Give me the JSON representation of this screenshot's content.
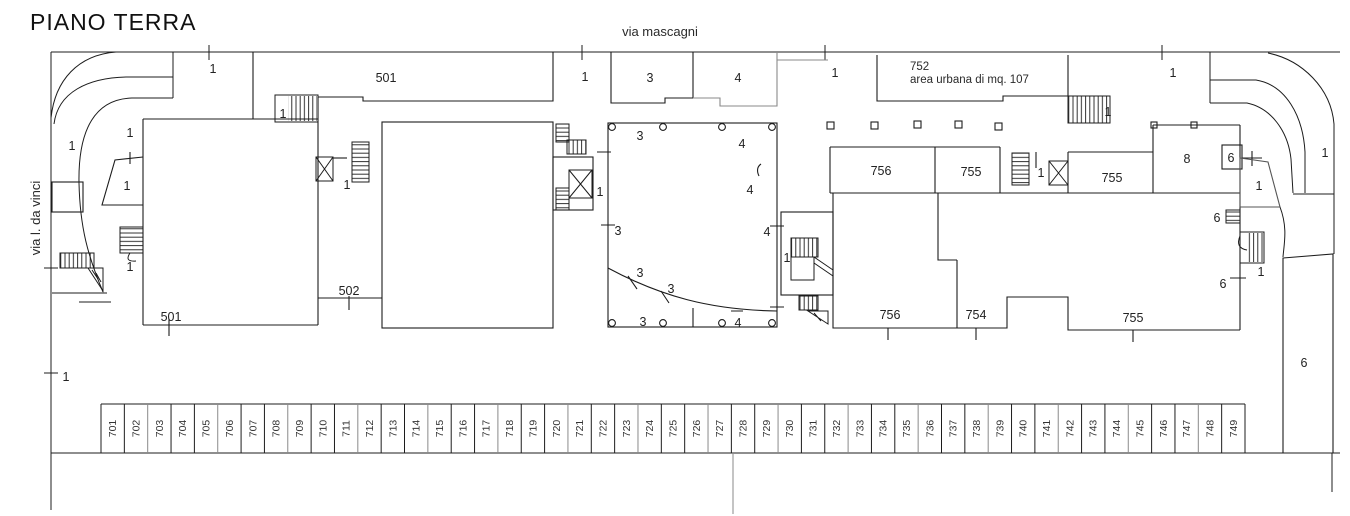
{
  "title": "PIANO TERRA",
  "streets": {
    "top": "via mascagni",
    "left": "via l. da vinci"
  },
  "parcel_752": {
    "number": "752",
    "note": "area urbana di mq. 107"
  },
  "colors": {
    "line": "#1c1c1c",
    "line_gray": "#8a8a8a",
    "text": "#222222",
    "background": "#ffffff"
  },
  "plan_labels": [
    {
      "t": "1",
      "x": 213,
      "y": 73
    },
    {
      "t": "1",
      "x": 585,
      "y": 81
    },
    {
      "t": "1",
      "x": 835,
      "y": 77
    },
    {
      "t": "1",
      "x": 1173,
      "y": 77
    },
    {
      "t": "501",
      "x": 386,
      "y": 82
    },
    {
      "t": "3",
      "x": 650,
      "y": 82
    },
    {
      "t": "4",
      "x": 738,
      "y": 82
    },
    {
      "t": "1",
      "x": 283,
      "y": 118
    },
    {
      "t": "1",
      "x": 72,
      "y": 150
    },
    {
      "t": "1",
      "x": 130,
      "y": 137
    },
    {
      "t": "1",
      "x": 127,
      "y": 190
    },
    {
      "t": "1",
      "x": 130,
      "y": 271
    },
    {
      "t": "1",
      "x": 347,
      "y": 189
    },
    {
      "t": "502",
      "x": 349,
      "y": 295
    },
    {
      "t": "501",
      "x": 171,
      "y": 321
    },
    {
      "t": "1",
      "x": 600,
      "y": 196
    },
    {
      "t": "3",
      "x": 640,
      "y": 140
    },
    {
      "t": "4",
      "x": 742,
      "y": 148
    },
    {
      "t": "4",
      "x": 750,
      "y": 194
    },
    {
      "t": "3",
      "x": 618,
      "y": 235
    },
    {
      "t": "4",
      "x": 767,
      "y": 236
    },
    {
      "t": "3",
      "x": 640,
      "y": 277
    },
    {
      "t": "3",
      "x": 671,
      "y": 293
    },
    {
      "t": "3",
      "x": 643,
      "y": 326
    },
    {
      "t": "4",
      "x": 738,
      "y": 327
    },
    {
      "t": "1",
      "x": 787,
      "y": 262
    },
    {
      "t": "1",
      "x": 1108,
      "y": 116
    },
    {
      "t": "756",
      "x": 881,
      "y": 175
    },
    {
      "t": "755",
      "x": 971,
      "y": 176
    },
    {
      "t": "1",
      "x": 1041,
      "y": 177
    },
    {
      "t": "755",
      "x": 1112,
      "y": 182
    },
    {
      "t": "8",
      "x": 1187,
      "y": 163
    },
    {
      "t": "6",
      "x": 1231,
      "y": 162
    },
    {
      "t": "1",
      "x": 1259,
      "y": 190
    },
    {
      "t": "1",
      "x": 1325,
      "y": 157
    },
    {
      "t": "6",
      "x": 1217,
      "y": 222
    },
    {
      "t": "1",
      "x": 1261,
      "y": 276
    },
    {
      "t": "6",
      "x": 1223,
      "y": 288
    },
    {
      "t": "756",
      "x": 890,
      "y": 319
    },
    {
      "t": "754",
      "x": 976,
      "y": 319
    },
    {
      "t": "755",
      "x": 1133,
      "y": 322
    },
    {
      "t": "6",
      "x": 1304,
      "y": 367
    },
    {
      "t": "1",
      "x": 66,
      "y": 381
    }
  ],
  "parking": {
    "stalls": [
      "701",
      "702",
      "703",
      "704",
      "705",
      "706",
      "707",
      "708",
      "709",
      "710",
      "711",
      "712",
      "713",
      "714",
      "715",
      "716",
      "717",
      "718",
      "719",
      "720",
      "721",
      "722",
      "723",
      "724",
      "725",
      "726",
      "727",
      "728",
      "729",
      "730",
      "731",
      "732",
      "733",
      "734",
      "735",
      "736",
      "737",
      "738",
      "739",
      "740",
      "741",
      "742",
      "743",
      "744",
      "745",
      "746",
      "747",
      "748",
      "749"
    ]
  }
}
